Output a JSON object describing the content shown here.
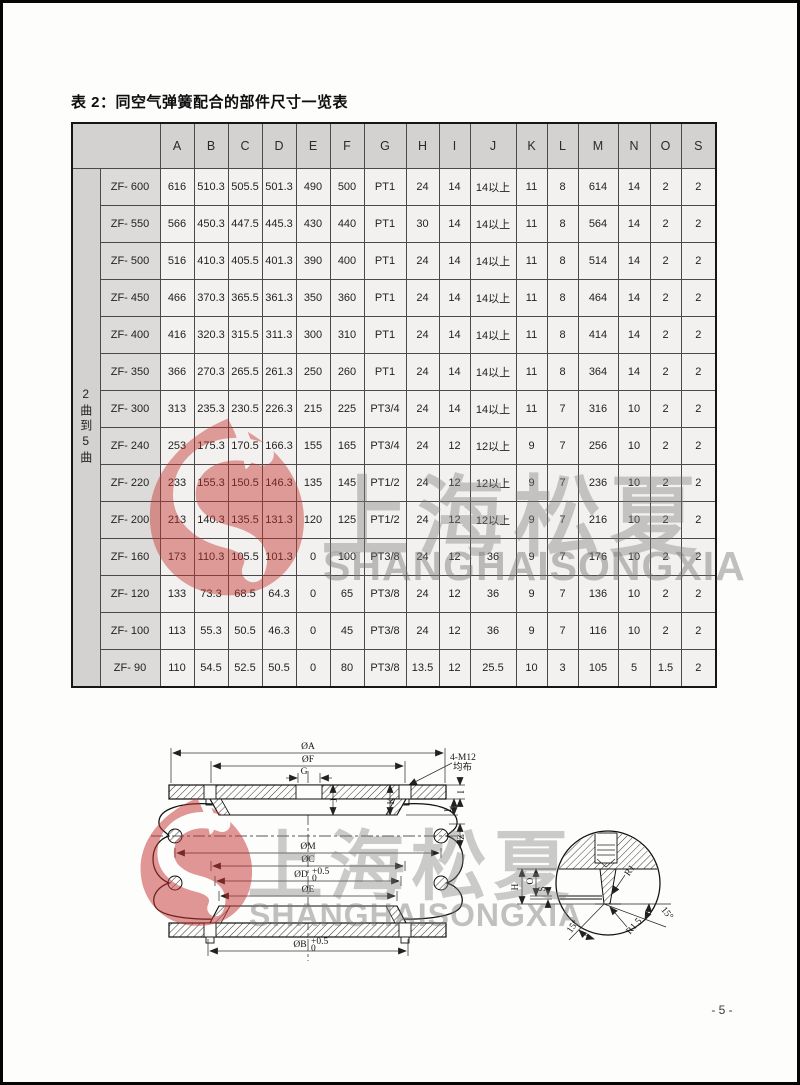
{
  "page": {
    "title": "表 2：同空气弹簧配合的部件尺寸一览表",
    "page_number": "- 5 -"
  },
  "watermark": {
    "cn": "上海松夏",
    "en": "SHANGHAISONGXIA",
    "logo_color": "#c4322e",
    "text_color": "#7d7d7d"
  },
  "table": {
    "group_label": "2曲到5曲",
    "columns": [
      "A",
      "B",
      "C",
      "D",
      "E",
      "F",
      "G",
      "H",
      "I",
      "J",
      "K",
      "L",
      "M",
      "N",
      "O",
      "S"
    ],
    "rows": [
      {
        "model": "ZF- 600",
        "values": [
          "616",
          "510.3",
          "505.5",
          "501.3",
          "490",
          "500",
          "PT1",
          "24",
          "14",
          "14以上",
          "11",
          "8",
          "614",
          "14",
          "2",
          "2"
        ]
      },
      {
        "model": "ZF- 550",
        "values": [
          "566",
          "450.3",
          "447.5",
          "445.3",
          "430",
          "440",
          "PT1",
          "30",
          "14",
          "14以上",
          "11",
          "8",
          "564",
          "14",
          "2",
          "2"
        ]
      },
      {
        "model": "ZF- 500",
        "values": [
          "516",
          "410.3",
          "405.5",
          "401.3",
          "390",
          "400",
          "PT1",
          "24",
          "14",
          "14以上",
          "11",
          "8",
          "514",
          "14",
          "2",
          "2"
        ]
      },
      {
        "model": "ZF- 450",
        "values": [
          "466",
          "370.3",
          "365.5",
          "361.3",
          "350",
          "360",
          "PT1",
          "24",
          "14",
          "14以上",
          "11",
          "8",
          "464",
          "14",
          "2",
          "2"
        ]
      },
      {
        "model": "ZF- 400",
        "values": [
          "416",
          "320.3",
          "315.5",
          "311.3",
          "300",
          "310",
          "PT1",
          "24",
          "14",
          "14以上",
          "11",
          "8",
          "414",
          "14",
          "2",
          "2"
        ]
      },
      {
        "model": "ZF- 350",
        "values": [
          "366",
          "270.3",
          "265.5",
          "261.3",
          "250",
          "260",
          "PT1",
          "24",
          "14",
          "14以上",
          "11",
          "8",
          "364",
          "14",
          "2",
          "2"
        ]
      },
      {
        "model": "ZF- 300",
        "values": [
          "313",
          "235.3",
          "230.5",
          "226.3",
          "215",
          "225",
          "PT3/4",
          "24",
          "14",
          "14以上",
          "11",
          "7",
          "316",
          "10",
          "2",
          "2"
        ]
      },
      {
        "model": "ZF- 240",
        "values": [
          "253",
          "175.3",
          "170.5",
          "166.3",
          "155",
          "165",
          "PT3/4",
          "24",
          "12",
          "12以上",
          "9",
          "7",
          "256",
          "10",
          "2",
          "2"
        ]
      },
      {
        "model": "ZF- 220",
        "values": [
          "233",
          "155.3",
          "150.5",
          "146.3",
          "135",
          "145",
          "PT1/2",
          "24",
          "12",
          "12以上",
          "9",
          "7",
          "236",
          "10",
          "2",
          "2"
        ]
      },
      {
        "model": "ZF- 200",
        "values": [
          "213",
          "140.3",
          "135.5",
          "131.3",
          "120",
          "125",
          "PT1/2",
          "24",
          "12",
          "12以上",
          "9",
          "7",
          "216",
          "10",
          "2",
          "2"
        ]
      },
      {
        "model": "ZF- 160",
        "values": [
          "173",
          "110.3",
          "105.5",
          "101.3",
          "0",
          "100",
          "PT3/8",
          "24",
          "12",
          "36",
          "9",
          "7",
          "176",
          "10",
          "2",
          "2"
        ]
      },
      {
        "model": "ZF- 120",
        "values": [
          "133",
          "73.3",
          "68.5",
          "64.3",
          "0",
          "65",
          "PT3/8",
          "24",
          "12",
          "36",
          "9",
          "7",
          "136",
          "10",
          "2",
          "2"
        ]
      },
      {
        "model": "ZF- 100",
        "values": [
          "113",
          "55.3",
          "50.5",
          "46.3",
          "0",
          "45",
          "PT3/8",
          "24",
          "12",
          "36",
          "9",
          "7",
          "116",
          "10",
          "2",
          "2"
        ]
      },
      {
        "model": "ZF- 90",
        "values": [
          "110",
          "54.5",
          "52.5",
          "50.5",
          "0",
          "80",
          "PT3/8",
          "13.5",
          "12",
          "25.5",
          "10",
          "3",
          "105",
          "5",
          "1.5",
          "2"
        ]
      }
    ]
  },
  "diagram": {
    "top": {
      "oa": "ØA",
      "of": "ØF",
      "g": "G",
      "bolt_line1": "4-M12",
      "bolt_line2": "均布"
    },
    "plate_dims": {
      "i": "I",
      "l": "L",
      "j": "J",
      "k": "K",
      "z": "Z"
    },
    "lower": {
      "om": "ØM",
      "oc": "ØC",
      "od_base": "ØD",
      "od_sup": "+0.5",
      "od_sub": "0",
      "oe": "ØE",
      "ob_base": "ØB",
      "ob_sup": "+0.5",
      "ob_sub": "0"
    },
    "detail": {
      "h": "H",
      "o": "O",
      "s": "S",
      "r1": "R1",
      "angle_left": "15°",
      "r15": "R1.5",
      "angle_right": "15°"
    }
  }
}
